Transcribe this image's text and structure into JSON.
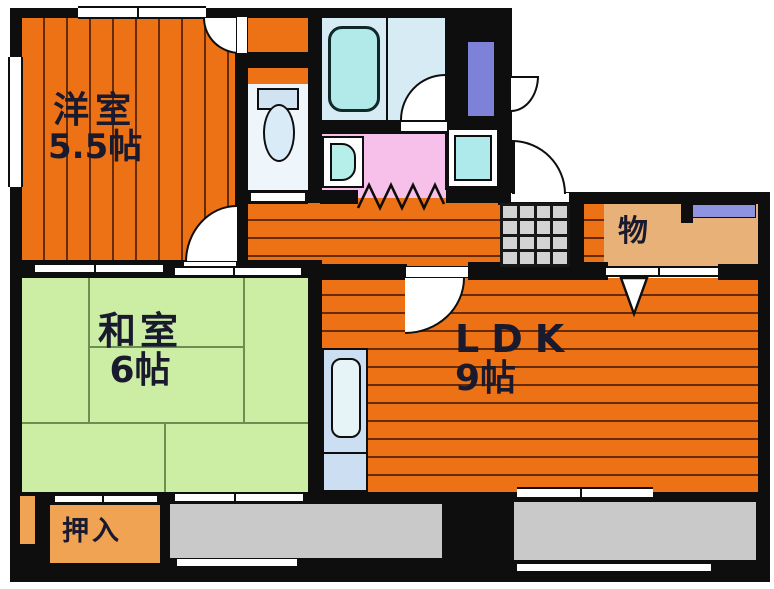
{
  "plan_type": "apartment-floor-plan",
  "rooms": {
    "western": {
      "label": "洋室",
      "size": "5.5帖"
    },
    "japanese": {
      "label": "和室",
      "size": "6帖"
    },
    "ldk": {
      "label": "LDK",
      "size": "9帖"
    },
    "storage": {
      "label": "物"
    },
    "closet": {
      "label": "押入"
    }
  },
  "fixtures": [
    "bathtub",
    "toilet",
    "washbasin",
    "washing-machine-pan",
    "kitchen-sink",
    "entrance-tiles",
    "water-heater",
    "folding-door",
    "entrance-door",
    "sliding-doors",
    "windows",
    "balcony"
  ],
  "colors": {
    "flooring_orange": "#ed7215",
    "tatami_green": "#cceda4",
    "closet_orange": "#f0a352",
    "storage_tan": "#e7b177",
    "balcony_gray": "#c9c9c9",
    "bath_blue": "#d7ebf5",
    "tub_cyan": "#b2e9e9",
    "washroom_pink": "#f6c0eb",
    "window_blue": "#8e93e2",
    "water_heater_purple": "#7e81d8",
    "wall_black": "#0e0e0e",
    "text_navy": "#1a1a2e"
  }
}
